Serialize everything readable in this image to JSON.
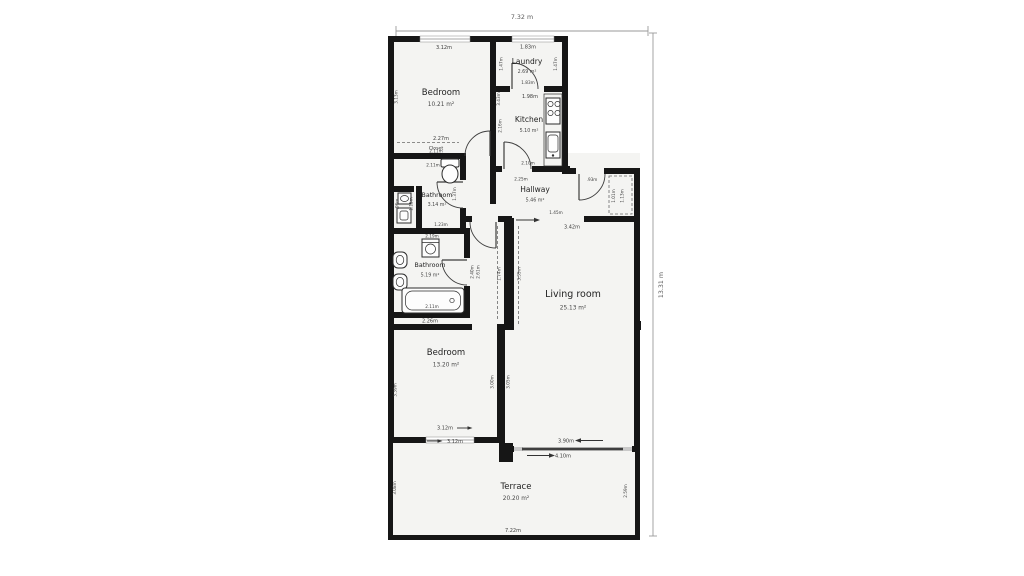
{
  "overall_dims": {
    "width": "7.32 m",
    "height": "13.31 m"
  },
  "rooms": {
    "bedroom1": {
      "name": "Bedroom",
      "area": "10.21 m²"
    },
    "laundry": {
      "name": "Laundry",
      "area": "2.69 m²"
    },
    "kitchen": {
      "name": "Kitchen",
      "area": "5.10 m²"
    },
    "bathroom1": {
      "name": "Bathroom",
      "area": "3.14 m²"
    },
    "hallway": {
      "name": "Hallway",
      "area": "5.46 m²"
    },
    "bathroom2": {
      "name": "Bathroom",
      "area": "5.19 m²"
    },
    "bedroom2": {
      "name": "Bedroom",
      "area": "13.20 m²"
    },
    "living_room": {
      "name": "Living room",
      "area": "25.13 m²"
    },
    "terrace": {
      "name": "Terrace",
      "area": "20.20 m²"
    },
    "closet": {
      "name": "Closet"
    }
  },
  "dims": {
    "bedroom1_top": "3.12m",
    "bedroom1_left": "3.13m",
    "bedroom1_right": "3.43m",
    "bedroom1_bottom": "2.27m",
    "closet_width": "2.11m",
    "bathroom1_top": "2.11m",
    "bathroom1_right": "1.37m",
    "bathroom1_wc_width": ".96m",
    "bathroom1_wc_height": "1.15m",
    "bathroom1_door": "1.23m",
    "laundry_top": "1.83m",
    "laundry_left": "1.47m",
    "laundry_right": "1.47m",
    "laundry_door": "1.83m",
    "kitchen_top": "1.98m",
    "kitchen_left": "2.16m",
    "kitchen_door": "2.10m",
    "hallway_left": "2.25m",
    "hallway_entry_door": ".93m",
    "hallway_closet_a": "1.01m",
    "hallway_closet_b": "1.13m",
    "living_opening": "1.45m",
    "living_top": "3.42m",
    "living_left_upper": "3.35m",
    "living_left_lower": "3.05m",
    "corridor": "1.74m",
    "bathroom2_top": "2.19m",
    "bathroom2_right_inner": "2.40m",
    "bathroom2_right_outer": "2.61m",
    "bathtub_width": "2.11m",
    "bathroom2_bottom": "2.26m",
    "bedroom2_left": "3.39m",
    "bedroom2_right": "3.00m",
    "bedroom2_window_a": "3.12m",
    "bedroom2_window_b": "3.12m",
    "living_door_a": "3.90m",
    "living_door_b": "4.10m",
    "terrace_left": "3.08m",
    "terrace_right": "2.59m",
    "terrace_bottom": "7.22m"
  }
}
